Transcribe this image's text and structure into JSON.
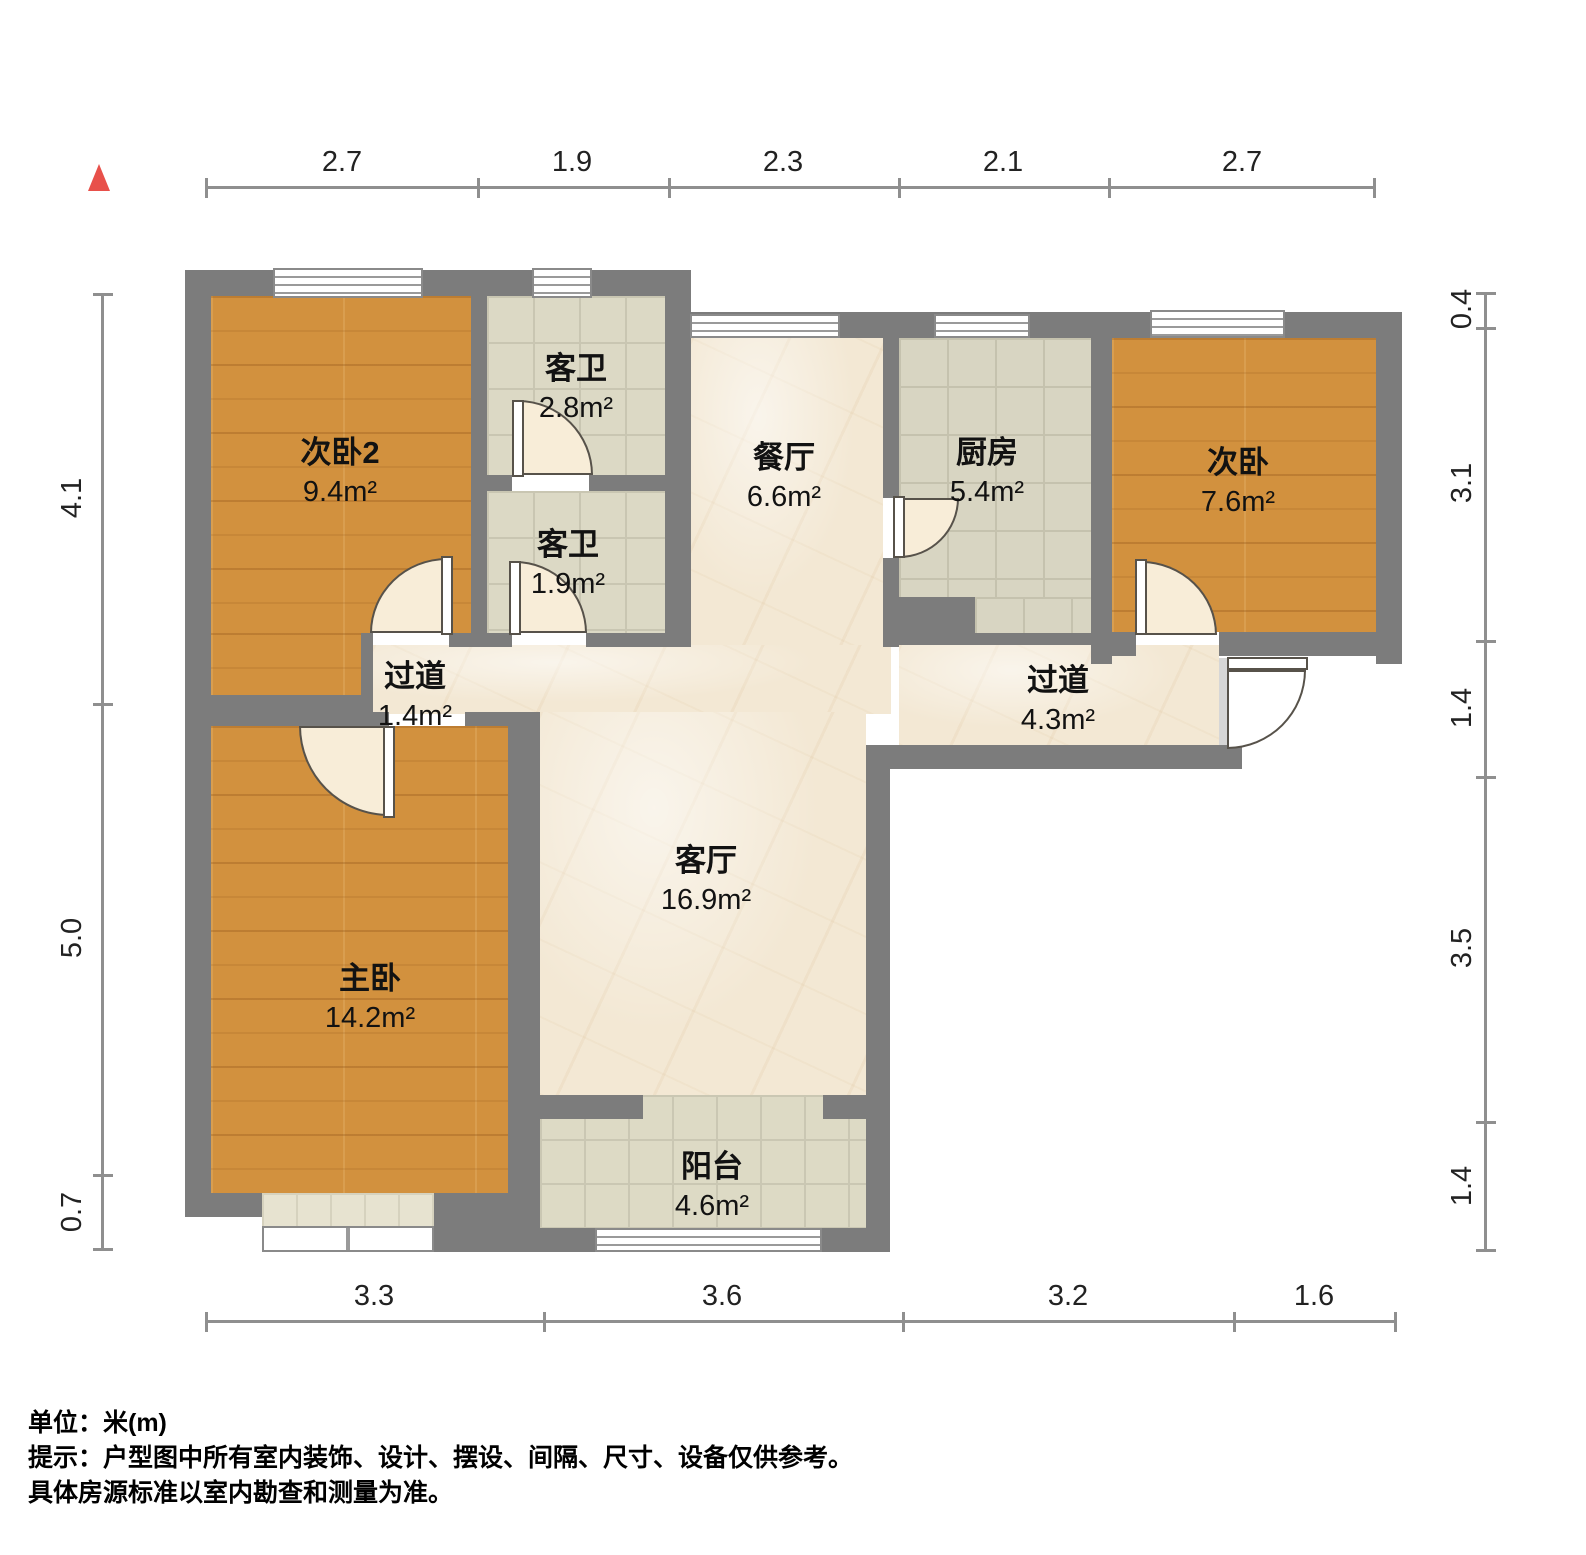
{
  "title": "户型图",
  "north_arrow": {
    "color": "#e8504a"
  },
  "rooms": [
    {
      "id": "bedroom2",
      "name": "次卧2",
      "area": "9.4m²"
    },
    {
      "id": "bath1",
      "name": "客卫",
      "area": "2.8m²"
    },
    {
      "id": "bath2",
      "name": "客卫",
      "area": "1.9m²"
    },
    {
      "id": "dining",
      "name": "餐厅",
      "area": "6.6m²"
    },
    {
      "id": "kitchen",
      "name": "厨房",
      "area": "5.4m²"
    },
    {
      "id": "bedroom",
      "name": "次卧",
      "area": "7.6m²"
    },
    {
      "id": "hallway1",
      "name": "过道",
      "area": "1.4m²"
    },
    {
      "id": "hallway2",
      "name": "过道",
      "area": "4.3m²"
    },
    {
      "id": "living",
      "name": "客厅",
      "area": "16.9m²"
    },
    {
      "id": "master",
      "name": "主卧",
      "area": "14.2m²"
    },
    {
      "id": "balcony",
      "name": "阳台",
      "area": "4.6m²"
    }
  ],
  "dimensions": {
    "top": [
      "2.7",
      "1.9",
      "2.3",
      "2.1",
      "2.7"
    ],
    "left": [
      "4.1",
      "5.0",
      "0.7"
    ],
    "right": [
      "0.4",
      "3.1",
      "1.4",
      "3.5",
      "1.4"
    ],
    "bottom": [
      "3.3",
      "3.6",
      "3.2",
      "1.6"
    ]
  },
  "notes": {
    "unit": "单位：米(m)",
    "tip_line1": "提示：户型图中所有室内装饰、设计、摆设、间隔、尺寸、设备仅供参考。",
    "tip_line2": "具体房源标准以室内勘查和测量为准。"
  },
  "colors": {
    "wall": "#7c7c7c",
    "wood_floor": "#d2913e",
    "tile_floor": "#dcd9c5",
    "marble_floor": "#f3e8d4",
    "north_arrow": "#e8504a"
  }
}
